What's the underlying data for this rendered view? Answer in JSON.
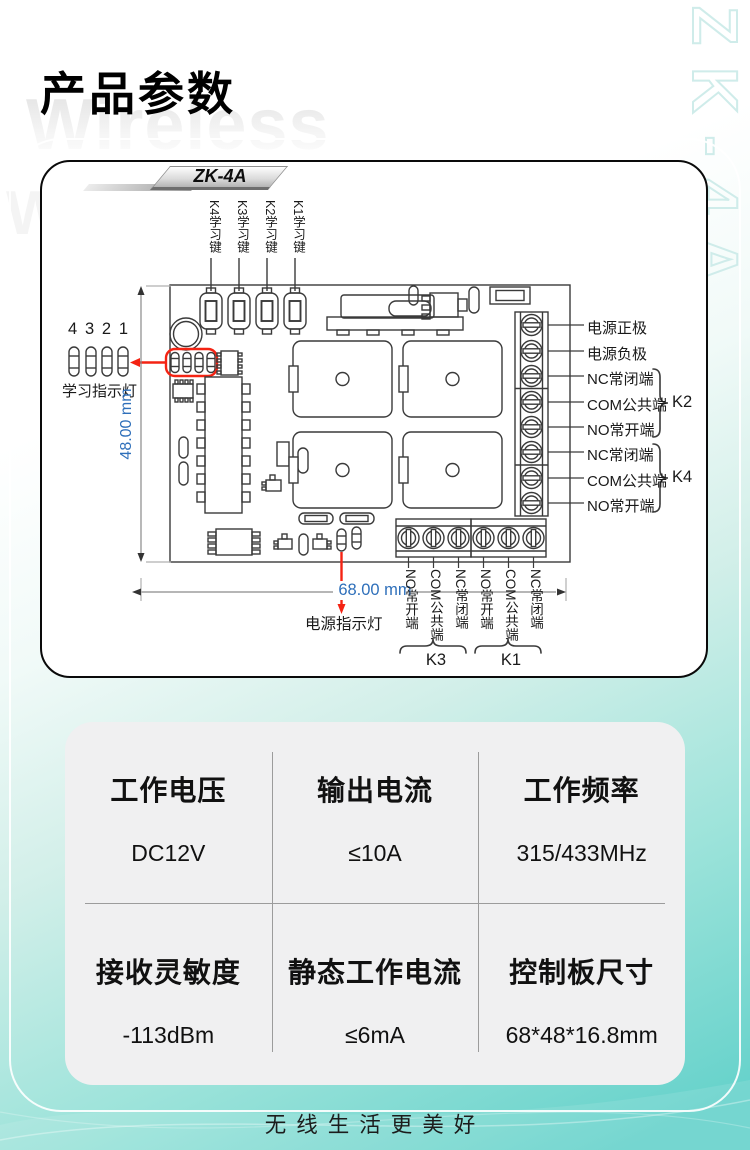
{
  "page": {
    "title": "产品参数",
    "bg_watermark_text": "Wireless",
    "side_watermark_text": "ZK-4A",
    "footer_slogan": "无线生活更美好"
  },
  "colors": {
    "accent_teal": "#66d2cb",
    "highlight_red": "#f42313",
    "dimension_blue": "#2e6fba",
    "line_dark": "#3a3a3a",
    "card_gray": "#f0f0f1"
  },
  "diagram": {
    "board_tag": "ZK-4A",
    "key_labels": [
      "K4学习键",
      "K3学习键",
      "K2学习键",
      "K1学习键"
    ],
    "led_digits": [
      "4",
      "3",
      "2",
      "1"
    ],
    "led_caption": "学习指示灯",
    "height_dimension": "48.00 mm",
    "width_dimension": "68.00 mm",
    "power_led_caption": "电源指示灯",
    "right_terminal_labels": [
      "电源正极",
      "电源负极",
      "NC常闭端",
      "COM公共端",
      "NO常开端",
      "NC常闭端",
      "COM公共端",
      "NO常开端"
    ],
    "right_groups": [
      "K2",
      "K4"
    ],
    "bottom_terminal_labels": [
      "NO常开端",
      "COM公共端",
      "NC常闭端",
      "NO常开端",
      "COM公共端",
      "NC常闭端"
    ],
    "bottom_groups": [
      "K3",
      "K1"
    ]
  },
  "specs": {
    "cells": [
      {
        "name": "工作电压",
        "value": "DC12V"
      },
      {
        "name": "输出电流",
        "value": "≤10A"
      },
      {
        "name": "工作频率",
        "value": "315/433MHz"
      },
      {
        "name": "接收灵敏度",
        "value": "-113dBm"
      },
      {
        "name": "静态工作电流",
        "value": "≤6mA"
      },
      {
        "name": "控制板尺寸",
        "value": "68*48*16.8mm"
      }
    ]
  }
}
